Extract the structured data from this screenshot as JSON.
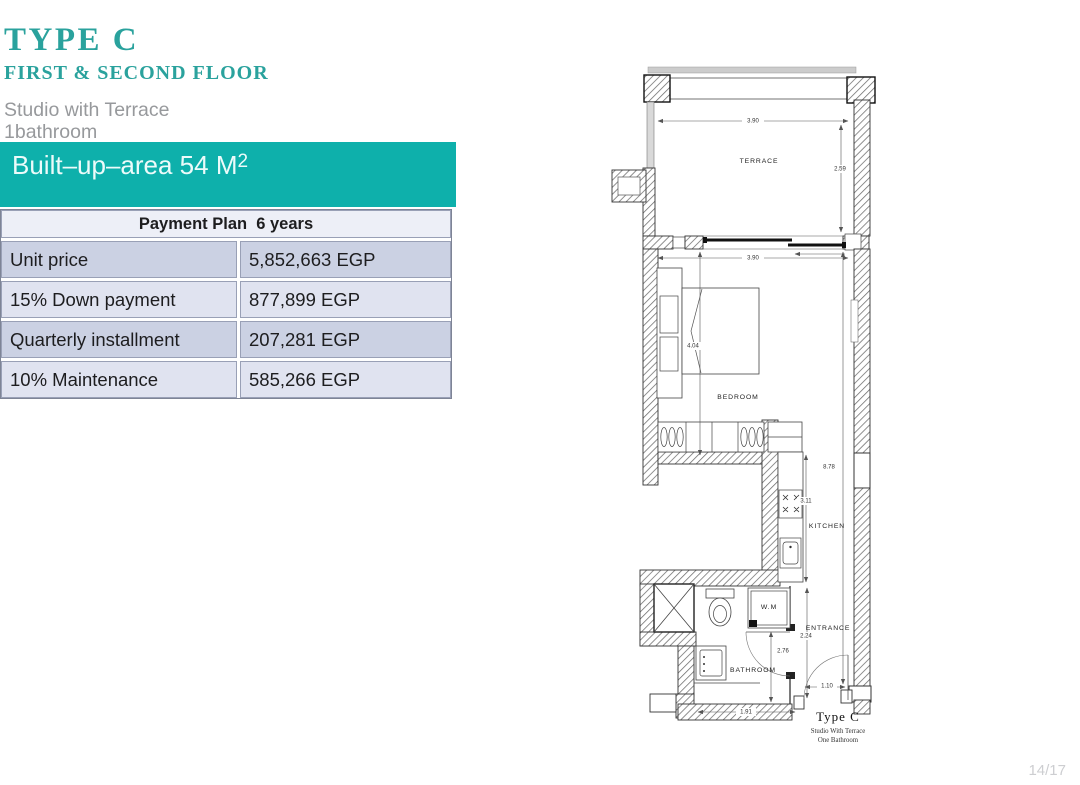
{
  "header": {
    "title": "TYPE C",
    "subtitle": "FIRST & SECOND FLOOR",
    "desc_line1": "Studio with Terrace",
    "desc_line2": "1bathroom"
  },
  "area_banner": {
    "text": "Built–up–area 54 M",
    "sup": "2"
  },
  "payment_table": {
    "title": "Payment Plan  6 years",
    "rows": [
      {
        "label": "Unit price",
        "value": "5,852,663 EGP"
      },
      {
        "label": "15% Down payment",
        "value": "877,899 EGP"
      },
      {
        "label": "Quarterly installment",
        "value": "207,281 EGP"
      },
      {
        "label": "10% Maintenance",
        "value": "585,266 EGP"
      }
    ]
  },
  "floorplan": {
    "rooms": {
      "terrace": "TERRACE",
      "bedroom": "BEDROOM",
      "kitchen": "KITCHEN",
      "bathroom": "BATHROOM",
      "entrance": "ENTRANCE",
      "washing_machine": "W.M"
    },
    "dims": {
      "terrace_width": "3.90",
      "terrace_depth": "2.59",
      "bedroom_width": "3.90",
      "bedroom_depth": "4.04",
      "total_depth": "8.78",
      "kitchen_length": "3.11",
      "entrance_length": "2.24",
      "hall_length": "2.76",
      "entry_door_width": "1.10",
      "bathroom_width": "1.91"
    },
    "caption": {
      "title": "Type C",
      "line1": "Studio With Terrace",
      "line2": "One Bathroom"
    }
  },
  "page_indicator": "14/17",
  "colors": {
    "teal_heading": "#2aa29d",
    "teal_banner": "#0eb0ab",
    "table_header_bg": "#edeff7",
    "table_row_dark": "#cbd1e3",
    "table_row_light": "#e0e3f0"
  }
}
